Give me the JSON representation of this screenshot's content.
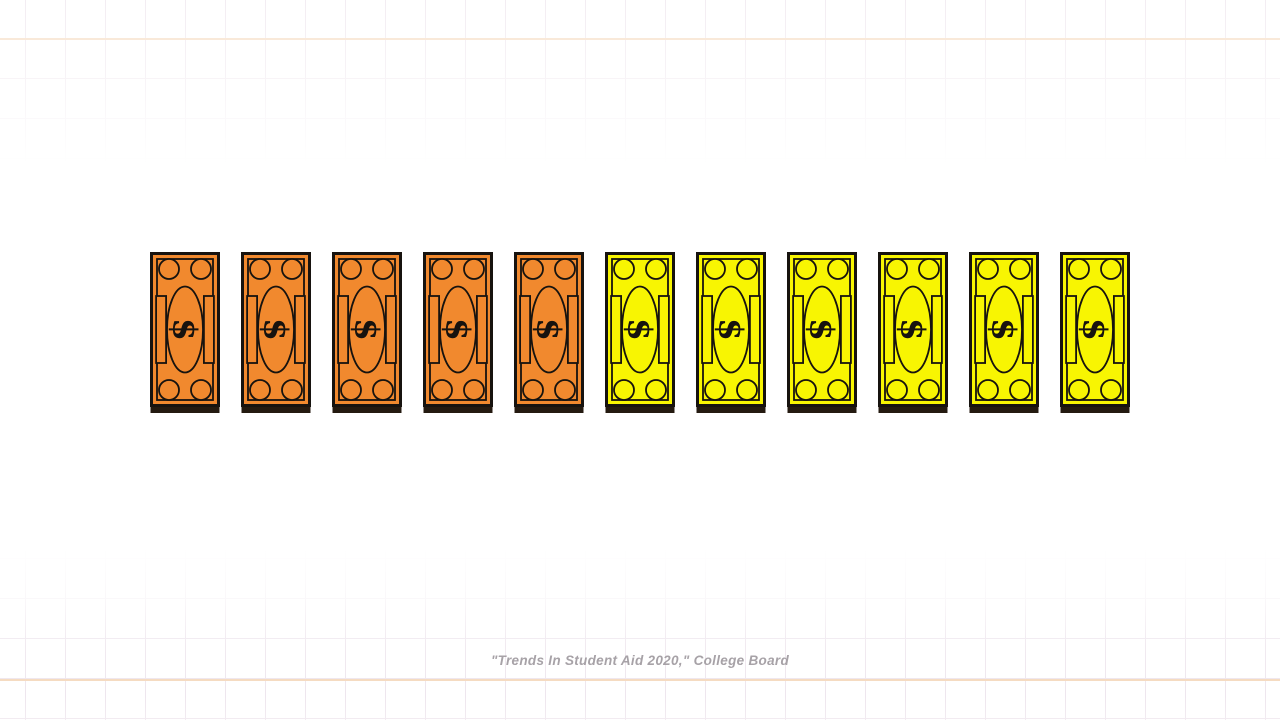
{
  "canvas": {
    "background": "#ffffff"
  },
  "grid": {
    "spacing_px": 40,
    "vertical_offset_px": 25,
    "horizontal_offset_px": 38,
    "line_color": "#e7dbe6",
    "accent_color": "#f0c9a2",
    "accent_lines_y": [
      38,
      679
    ]
  },
  "chart_data": {
    "type": "pictograph",
    "title": "",
    "unit_icon": "dollar-bill",
    "total_units": 11,
    "series": [
      {
        "name": "orange bills",
        "count": 5,
        "color": "#F1892E"
      },
      {
        "name": "yellow bills",
        "count": 6,
        "color": "#F8F502"
      }
    ],
    "outline_color": "#17130f",
    "shadow_color": "#241a10",
    "legend_position": "none",
    "grid_background": true,
    "source": "\"Trends In Student Aid 2020,\" College Board"
  },
  "caption": {
    "text": "\"Trends In Student Aid 2020,\" College Board",
    "color": "#a7a2a7"
  }
}
